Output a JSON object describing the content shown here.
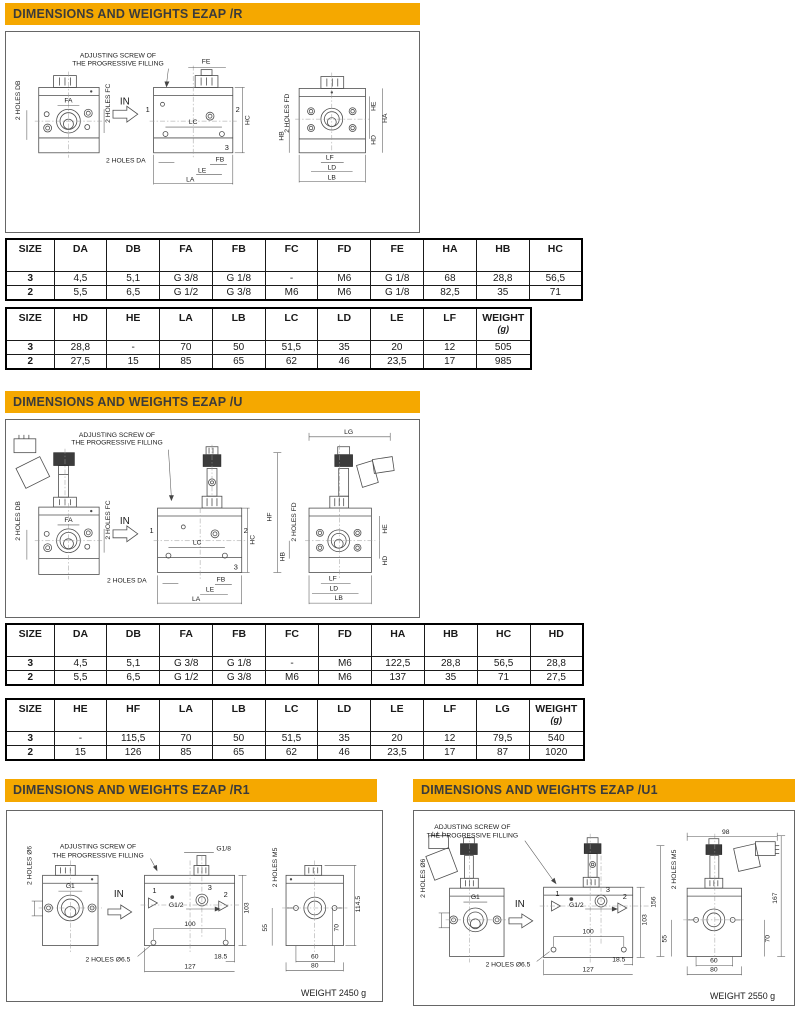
{
  "accent_color": "#F5A800",
  "sections": {
    "r": {
      "title": "DIMENSIONS AND WEIGHTS EZAP /R",
      "table1": {
        "headers": [
          "SIZE",
          "DA",
          "DB",
          "FA",
          "FB",
          "FC",
          "FD",
          "FE",
          "HA",
          "HB",
          "HC"
        ],
        "rows": [
          [
            "3",
            "4,5",
            "5,1",
            "G 3/8",
            "G 1/8",
            "-",
            "M6",
            "G 1/8",
            "68",
            "28,8",
            "56,5"
          ],
          [
            "2",
            "5,5",
            "6,5",
            "G 1/2",
            "G 3/8",
            "M6",
            "M6",
            "G 1/8",
            "82,5",
            "35",
            "71"
          ]
        ]
      },
      "table2": {
        "headers": [
          "SIZE",
          "HD",
          "HE",
          "LA",
          "LB",
          "LC",
          "LD",
          "LE",
          "LF",
          {
            "l1": "WEIGHT",
            "l2": "(g)"
          }
        ],
        "rows": [
          [
            "3",
            "28,8",
            "-",
            "70",
            "50",
            "51,5",
            "35",
            "20",
            "12",
            "505"
          ],
          [
            "2",
            "27,5",
            "15",
            "85",
            "65",
            "62",
            "46",
            "23,5",
            "17",
            "985"
          ]
        ]
      },
      "labels": [
        {
          "t": "ADJUSTING SCREW OF",
          "x": 117,
          "y": 57,
          "n": "note-line"
        },
        {
          "t": "THE PROGRESSIVE FILLING",
          "x": 117,
          "y": 65,
          "n": "note-line"
        },
        {
          "t": "2 HOLES DB",
          "x": 18,
          "y": 100,
          "r": -90
        },
        {
          "t": "2 HOLES FC",
          "x": 109,
          "y": 103,
          "r": -90
        },
        {
          "t": "FA",
          "x": 67,
          "y": 102
        },
        {
          "t": "IN",
          "x": 124,
          "y": 104,
          "s": 10
        },
        {
          "t": "FE",
          "x": 206,
          "y": 63
        },
        {
          "t": "1",
          "x": 147,
          "y": 112,
          "s": 7.5
        },
        {
          "t": "2",
          "x": 238,
          "y": 112,
          "s": 7.5
        },
        {
          "t": "3",
          "x": 227,
          "y": 150,
          "s": 7.5
        },
        {
          "t": "LC",
          "x": 193,
          "y": 124
        },
        {
          "t": "HC",
          "x": 250,
          "y": 120,
          "r": -90
        },
        {
          "t": "2 HOLES DA",
          "x": 125,
          "y": 163
        },
        {
          "t": "FB",
          "x": 220,
          "y": 162
        },
        {
          "t": "LE",
          "x": 202,
          "y": 173
        },
        {
          "t": "LA",
          "x": 190,
          "y": 182
        },
        {
          "t": "2 HOLES FD",
          "x": 290,
          "y": 113,
          "r": -90
        },
        {
          "t": "HB",
          "x": 284,
          "y": 136,
          "r": -90
        },
        {
          "t": "HE",
          "x": 377,
          "y": 106,
          "r": -90
        },
        {
          "t": "HA",
          "x": 389,
          "y": 118,
          "r": -90
        },
        {
          "t": "HD",
          "x": 377,
          "y": 140,
          "r": -90
        },
        {
          "t": "LF",
          "x": 331,
          "y": 160
        },
        {
          "t": "LD",
          "x": 333,
          "y": 170
        },
        {
          "t": "LB",
          "x": 333,
          "y": 180
        }
      ]
    },
    "u": {
      "title": "DIMENSIONS AND WEIGHTS EZAP /U",
      "table1": {
        "headers": [
          "SIZE",
          "DA",
          "DB",
          "FA",
          "FB",
          "FC",
          "FD",
          "HA",
          "HB",
          "HC",
          "HD"
        ],
        "rows": [
          [
            "3",
            "4,5",
            "5,1",
            "G 3/8",
            "G 1/8",
            "-",
            "M6",
            "122,5",
            "28,8",
            "56,5",
            "28,8"
          ],
          [
            "2",
            "5,5",
            "6,5",
            "G 1/2",
            "G 3/8",
            "M6",
            "M6",
            "137",
            "35",
            "71",
            "27,5"
          ]
        ]
      },
      "table2": {
        "headers": [
          "SIZE",
          "HE",
          "HF",
          "LA",
          "LB",
          "LC",
          "LD",
          "LE",
          "LF",
          "LG",
          {
            "l1": "WEIGHT",
            "l2": "(g)"
          }
        ],
        "rows": [
          [
            "3",
            "-",
            "115,5",
            "70",
            "50",
            "51,5",
            "35",
            "20",
            "12",
            "79,5",
            "540"
          ],
          [
            "2",
            "15",
            "126",
            "85",
            "65",
            "62",
            "46",
            "23,5",
            "17",
            "87",
            "1020"
          ]
        ]
      },
      "labels": [
        {
          "t": "ADJUSTING SCREW OF",
          "x": 116,
          "y": 436,
          "n": "note-line"
        },
        {
          "t": "THE PROGRESSIVE FILLING",
          "x": 116,
          "y": 444,
          "n": "note-line"
        },
        {
          "t": "2 HOLES DB",
          "x": 18,
          "y": 521,
          "r": -90
        },
        {
          "t": "2 HOLES FC",
          "x": 109,
          "y": 520,
          "r": -90
        },
        {
          "t": "FA",
          "x": 67,
          "y": 522
        },
        {
          "t": "IN",
          "x": 124,
          "y": 524,
          "s": 10
        },
        {
          "t": "1",
          "x": 151,
          "y": 533,
          "s": 7.5
        },
        {
          "t": "2",
          "x": 246,
          "y": 533,
          "s": 7.5
        },
        {
          "t": "3",
          "x": 236,
          "y": 570,
          "s": 7.5
        },
        {
          "t": "LC",
          "x": 197,
          "y": 545
        },
        {
          "t": "HC",
          "x": 255,
          "y": 540,
          "r": -90
        },
        {
          "t": "2 HOLES DA",
          "x": 126,
          "y": 583
        },
        {
          "t": "FB",
          "x": 221,
          "y": 582
        },
        {
          "t": "LE",
          "x": 210,
          "y": 592
        },
        {
          "t": "LA",
          "x": 196,
          "y": 602
        },
        {
          "t": "LG",
          "x": 350,
          "y": 433
        },
        {
          "t": "HF",
          "x": 272,
          "y": 517,
          "r": -90
        },
        {
          "t": "2 HOLES FD",
          "x": 297,
          "y": 522,
          "r": -90
        },
        {
          "t": "HB",
          "x": 285,
          "y": 557,
          "r": -90
        },
        {
          "t": "HE",
          "x": 389,
          "y": 529,
          "r": -90
        },
        {
          "t": "HD",
          "x": 389,
          "y": 561,
          "r": -90
        },
        {
          "t": "LF",
          "x": 334,
          "y": 581
        },
        {
          "t": "LD",
          "x": 335,
          "y": 591
        },
        {
          "t": "LB",
          "x": 340,
          "y": 601
        }
      ]
    },
    "r1": {
      "title": "DIMENSIONS AND WEIGHTS EZAP /R1",
      "labels": [
        {
          "t": "ADJUSTING SCREW OF",
          "x": 97,
          "y": 848,
          "n": "note-line"
        },
        {
          "t": "THE PROGRESSIVE FILLING",
          "x": 97,
          "y": 857,
          "n": "note-line"
        },
        {
          "t": "2 HOLES Ø6",
          "x": 30,
          "y": 865,
          "r": -90
        },
        {
          "t": "G1",
          "x": 69,
          "y": 888
        },
        {
          "t": "IN",
          "x": 118,
          "y": 897,
          "s": 10
        },
        {
          "t": "2 HOLES Ø6.5",
          "x": 107,
          "y": 962
        },
        {
          "t": "G1/8",
          "x": 224,
          "y": 850
        },
        {
          "t": "3",
          "x": 210,
          "y": 890,
          "s": 7.5
        },
        {
          "t": "1",
          "x": 154,
          "y": 893,
          "s": 7.5
        },
        {
          "t": "G1/2",
          "x": 176,
          "y": 907
        },
        {
          "t": "2",
          "x": 226,
          "y": 897,
          "s": 7.5
        },
        {
          "t": "103",
          "x": 249,
          "y": 908,
          "r": -90
        },
        {
          "t": "100",
          "x": 190,
          "y": 926
        },
        {
          "t": "18.5",
          "x": 221,
          "y": 959
        },
        {
          "t": "127",
          "x": 190,
          "y": 969
        },
        {
          "t": "2 HOLES M5",
          "x": 278,
          "y": 867,
          "r": -90
        },
        {
          "t": "55",
          "x": 268,
          "y": 928,
          "r": -90
        },
        {
          "t": "70",
          "x": 340,
          "y": 928,
          "r": -90
        },
        {
          "t": "114.5",
          "x": 362,
          "y": 904,
          "r": -90
        },
        {
          "t": "60",
          "x": 316,
          "y": 959
        },
        {
          "t": "80",
          "x": 316,
          "y": 968
        },
        {
          "t": "WEIGHT 2450 g",
          "x": 335,
          "y": 997,
          "s": 9,
          "n": "weight-label"
        }
      ]
    },
    "u1": {
      "title": "DIMENSIONS AND WEIGHTS EZAP /U1",
      "labels": [
        {
          "t": "ADJUSTING SCREW OF",
          "x": 471,
          "y": 828,
          "n": "note-line"
        },
        {
          "t": "THE PROGRESSIVE FILLING",
          "x": 471,
          "y": 837,
          "n": "note-line"
        },
        {
          "t": "2 HOLES Ø6",
          "x": 423,
          "y": 878,
          "r": -90
        },
        {
          "t": "G1",
          "x": 474,
          "y": 899
        },
        {
          "t": "IN",
          "x": 519,
          "y": 907,
          "s": 10
        },
        {
          "t": "2 HOLES Ø6.5",
          "x": 507,
          "y": 967
        },
        {
          "t": "3",
          "x": 608,
          "y": 892,
          "s": 7.5
        },
        {
          "t": "1",
          "x": 557,
          "y": 896,
          "s": 7.5
        },
        {
          "t": "G1/2",
          "x": 576,
          "y": 907
        },
        {
          "t": "2",
          "x": 625,
          "y": 899,
          "s": 7.5
        },
        {
          "t": "103",
          "x": 647,
          "y": 920,
          "r": -90
        },
        {
          "t": "100",
          "x": 588,
          "y": 934
        },
        {
          "t": "18.5",
          "x": 619,
          "y": 962
        },
        {
          "t": "127",
          "x": 588,
          "y": 972
        },
        {
          "t": "98",
          "x": 727,
          "y": 833
        },
        {
          "t": "156",
          "x": 656,
          "y": 902,
          "r": -90
        },
        {
          "t": "167",
          "x": 779,
          "y": 898,
          "r": -90
        },
        {
          "t": "2 HOLES M5",
          "x": 677,
          "y": 869,
          "r": -90
        },
        {
          "t": "55",
          "x": 667,
          "y": 939,
          "r": -90
        },
        {
          "t": "70",
          "x": 771,
          "y": 939,
          "r": -90
        },
        {
          "t": "60",
          "x": 715,
          "y": 963
        },
        {
          "t": "80",
          "x": 715,
          "y": 972
        },
        {
          "t": "WEIGHT 2550 g",
          "x": 744,
          "y": 1000,
          "s": 9,
          "n": "weight-label"
        }
      ]
    }
  }
}
